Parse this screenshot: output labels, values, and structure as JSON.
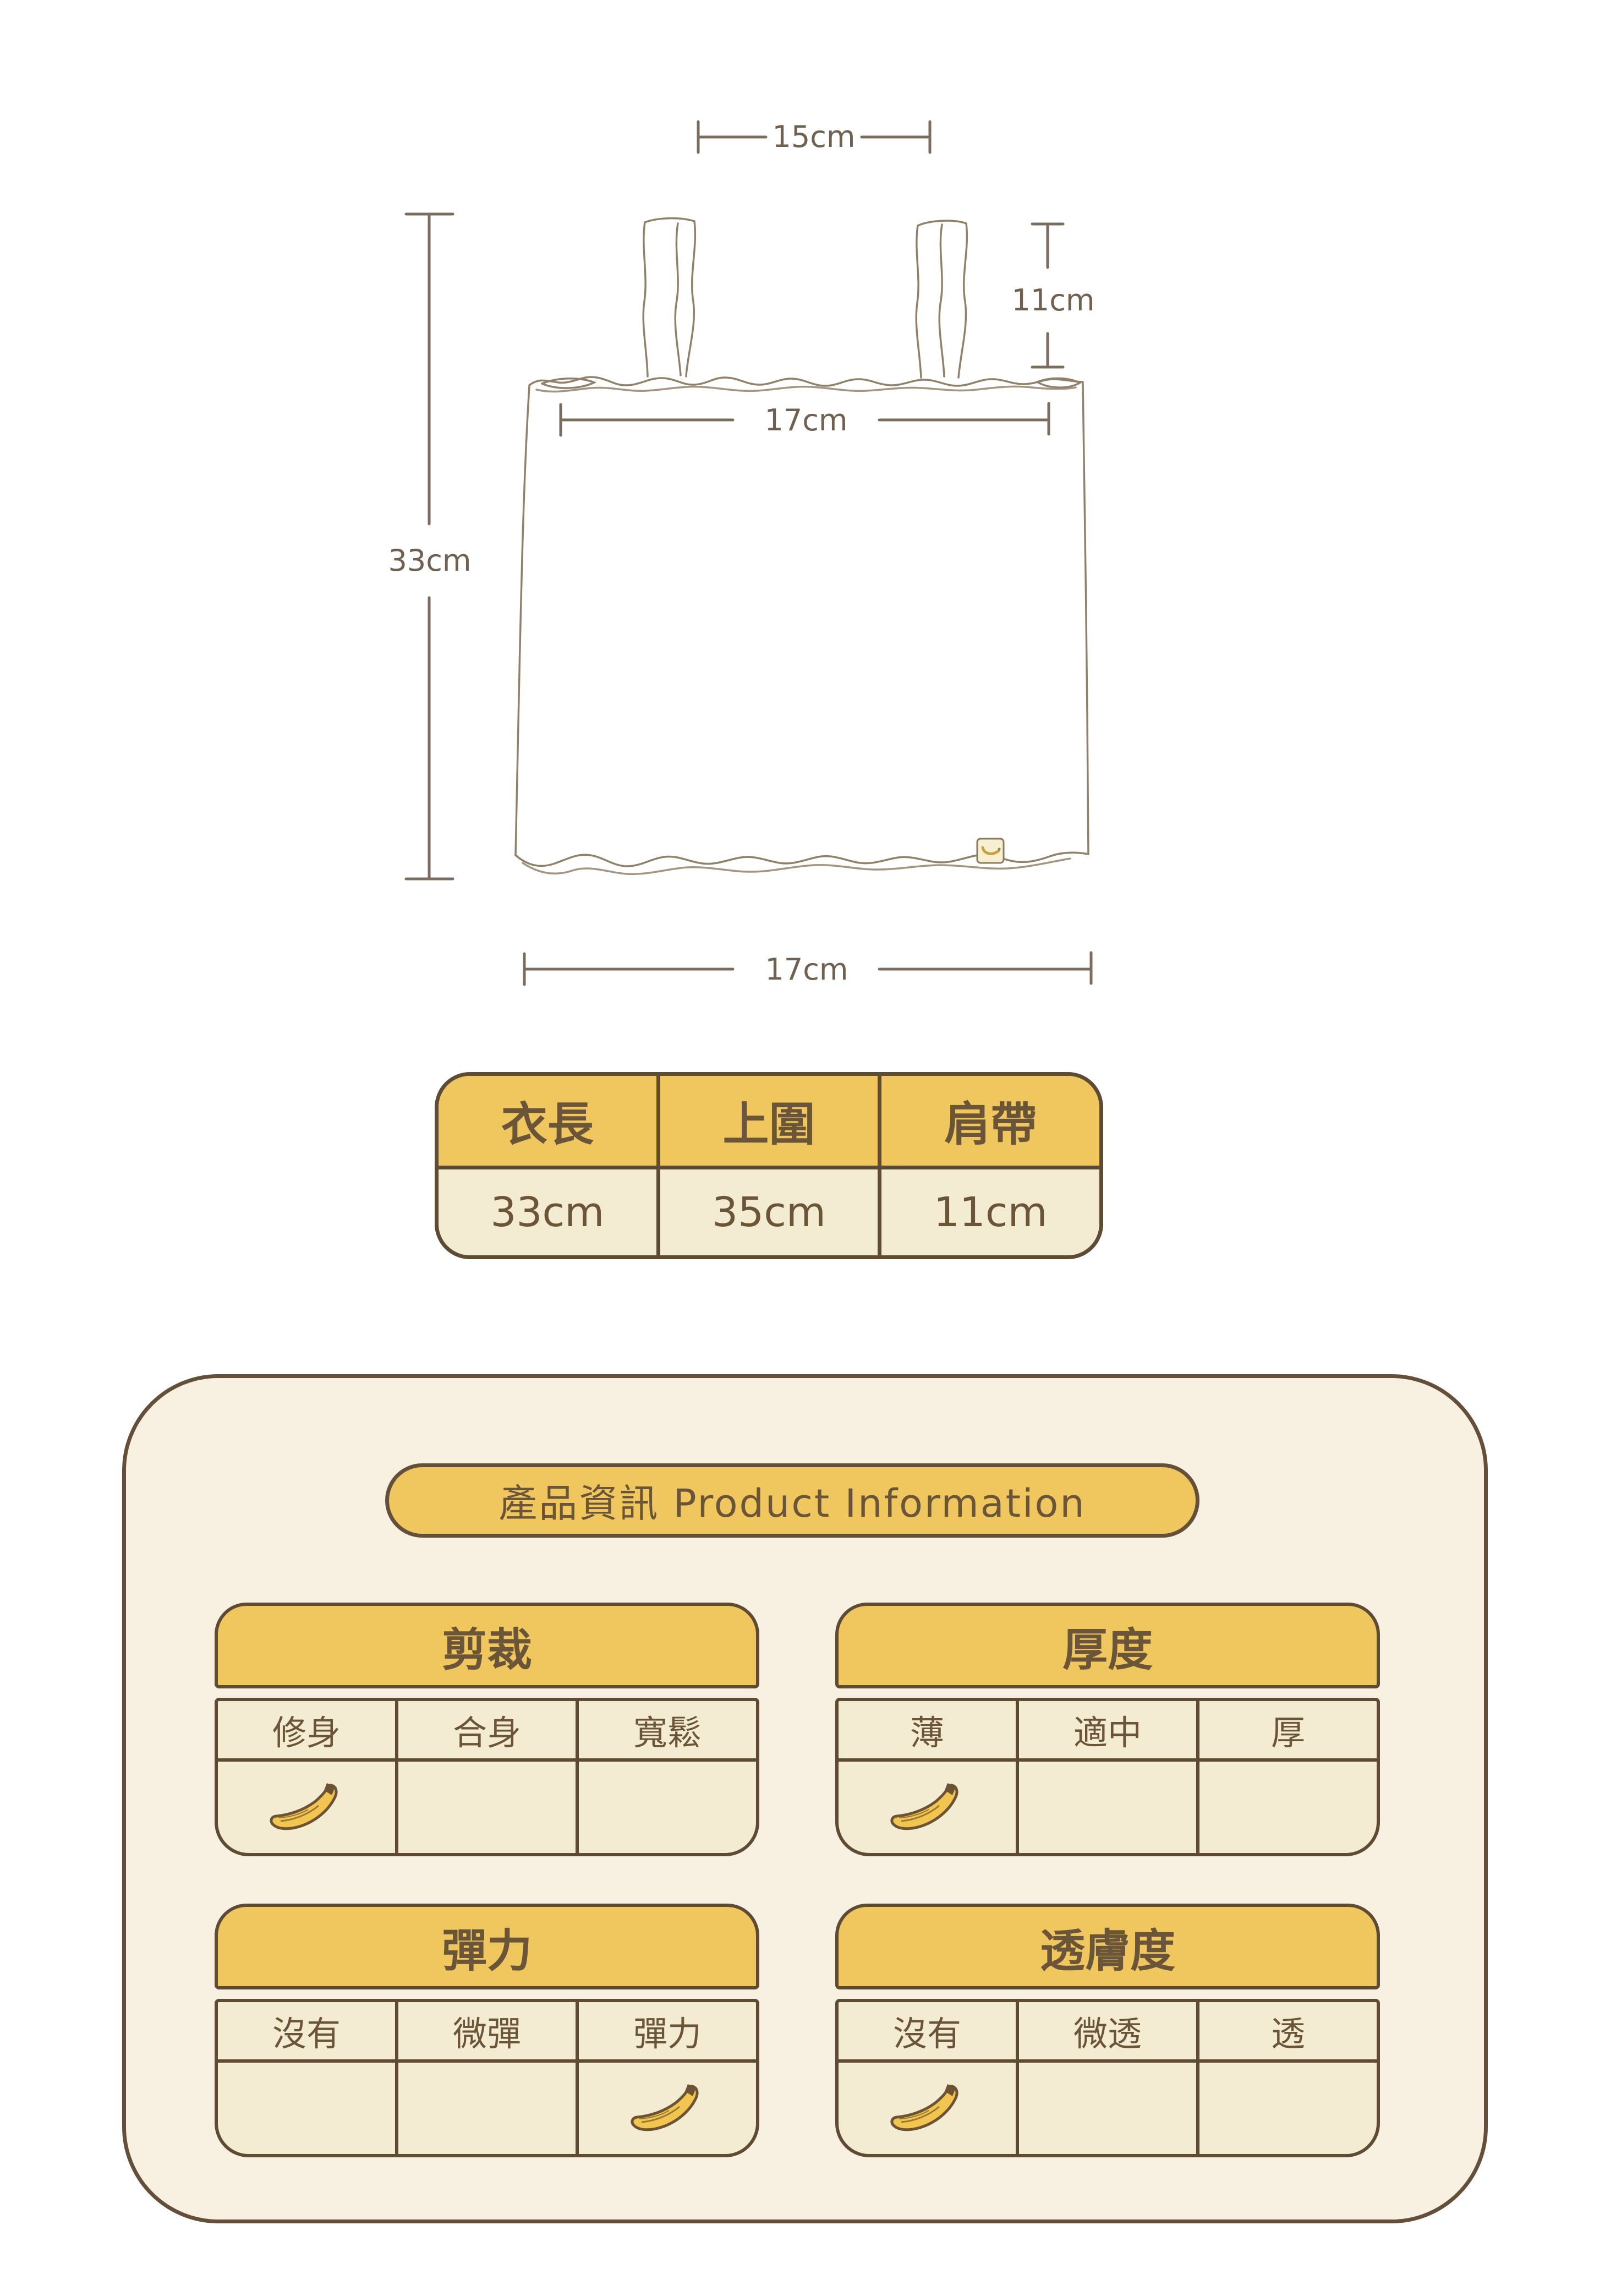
{
  "colors": {
    "accent_yellow": "#F0C75F",
    "cell_cream": "#F4EBD3",
    "panel_cream": "#F8F1E2",
    "border_brown": "#5E4B33",
    "text_brown": "#6B5538",
    "sketch_line": "#8B7B63",
    "dimension_line": "#6F6152",
    "banana_yellow": "#F1C54F"
  },
  "diagram": {
    "labels": {
      "strap_span": "15cm",
      "strap_length": "11cm",
      "top_width": "17cm",
      "garment_length": "33cm",
      "bottom_width": "17cm"
    }
  },
  "size_table": {
    "headers": [
      "衣長",
      "上圍",
      "肩帶"
    ],
    "values": [
      "33cm",
      "35cm",
      "11cm"
    ]
  },
  "product_info": {
    "title": "產品資訊 Product Information",
    "marker": "banana-icon",
    "tables": [
      {
        "title": "剪裁",
        "options": [
          "修身",
          "合身",
          "寬鬆"
        ],
        "selected_index": 0,
        "selected_option": "修身"
      },
      {
        "title": "厚度",
        "options": [
          "薄",
          "適中",
          "厚"
        ],
        "selected_index": 0,
        "selected_option": "薄"
      },
      {
        "title": "彈力",
        "options": [
          "沒有",
          "微彈",
          "彈力"
        ],
        "selected_index": 2,
        "selected_option": "彈力"
      },
      {
        "title": "透膚度",
        "options": [
          "沒有",
          "微透",
          "透"
        ],
        "selected_index": 0,
        "selected_option": "沒有"
      }
    ]
  }
}
